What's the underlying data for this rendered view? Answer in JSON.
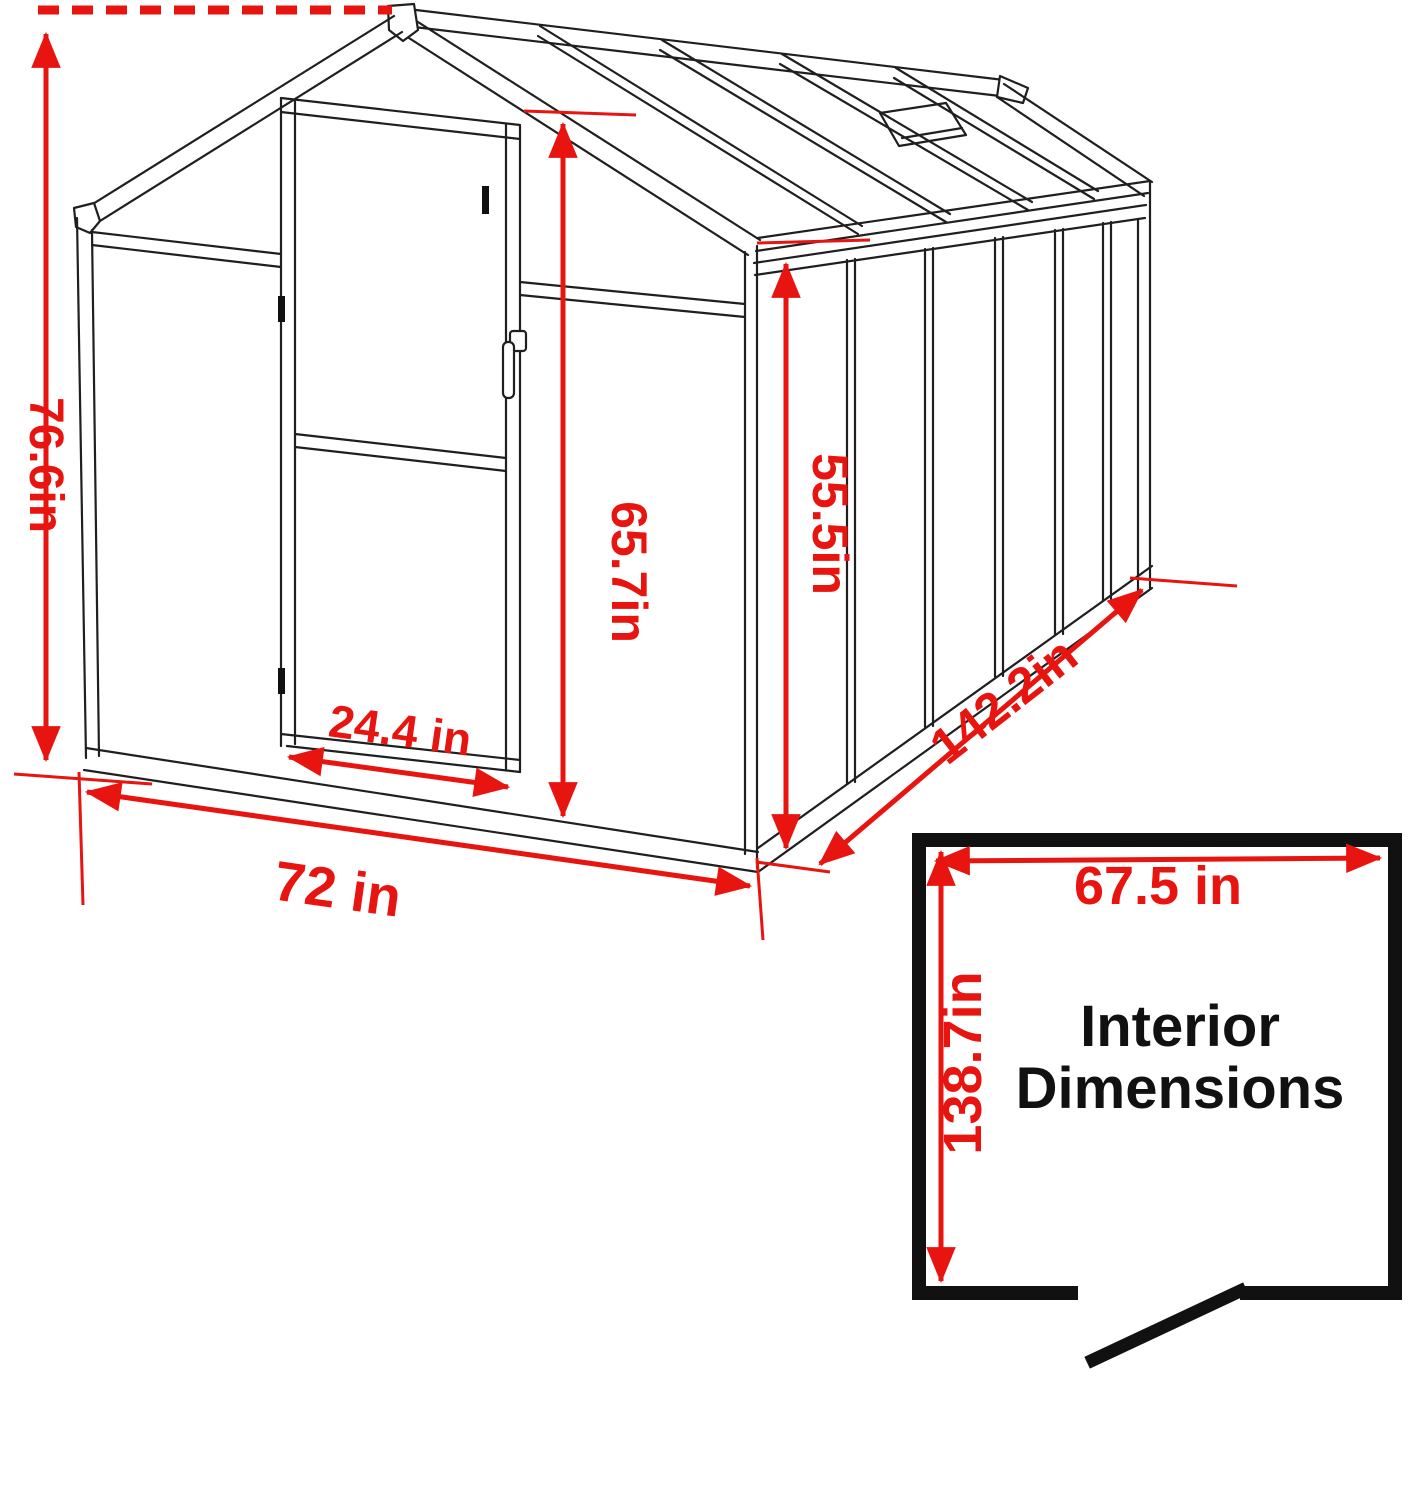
{
  "figure": {
    "kind": "greenhouse dimension drawing",
    "accent_color": "#e8140f",
    "line_color": "#1f1f1f"
  },
  "dimensions": {
    "overall_height": "76.6in",
    "door_height": "65.7in",
    "side_wall_height": "55.5in",
    "door_width": "24.4 in",
    "front_width": "72 in",
    "depth": "142.2in"
  },
  "interior_box": {
    "title_line1": "Interior",
    "title_line2": "Dimensions",
    "interior_width": "67.5 in",
    "interior_depth": "138.7in"
  }
}
